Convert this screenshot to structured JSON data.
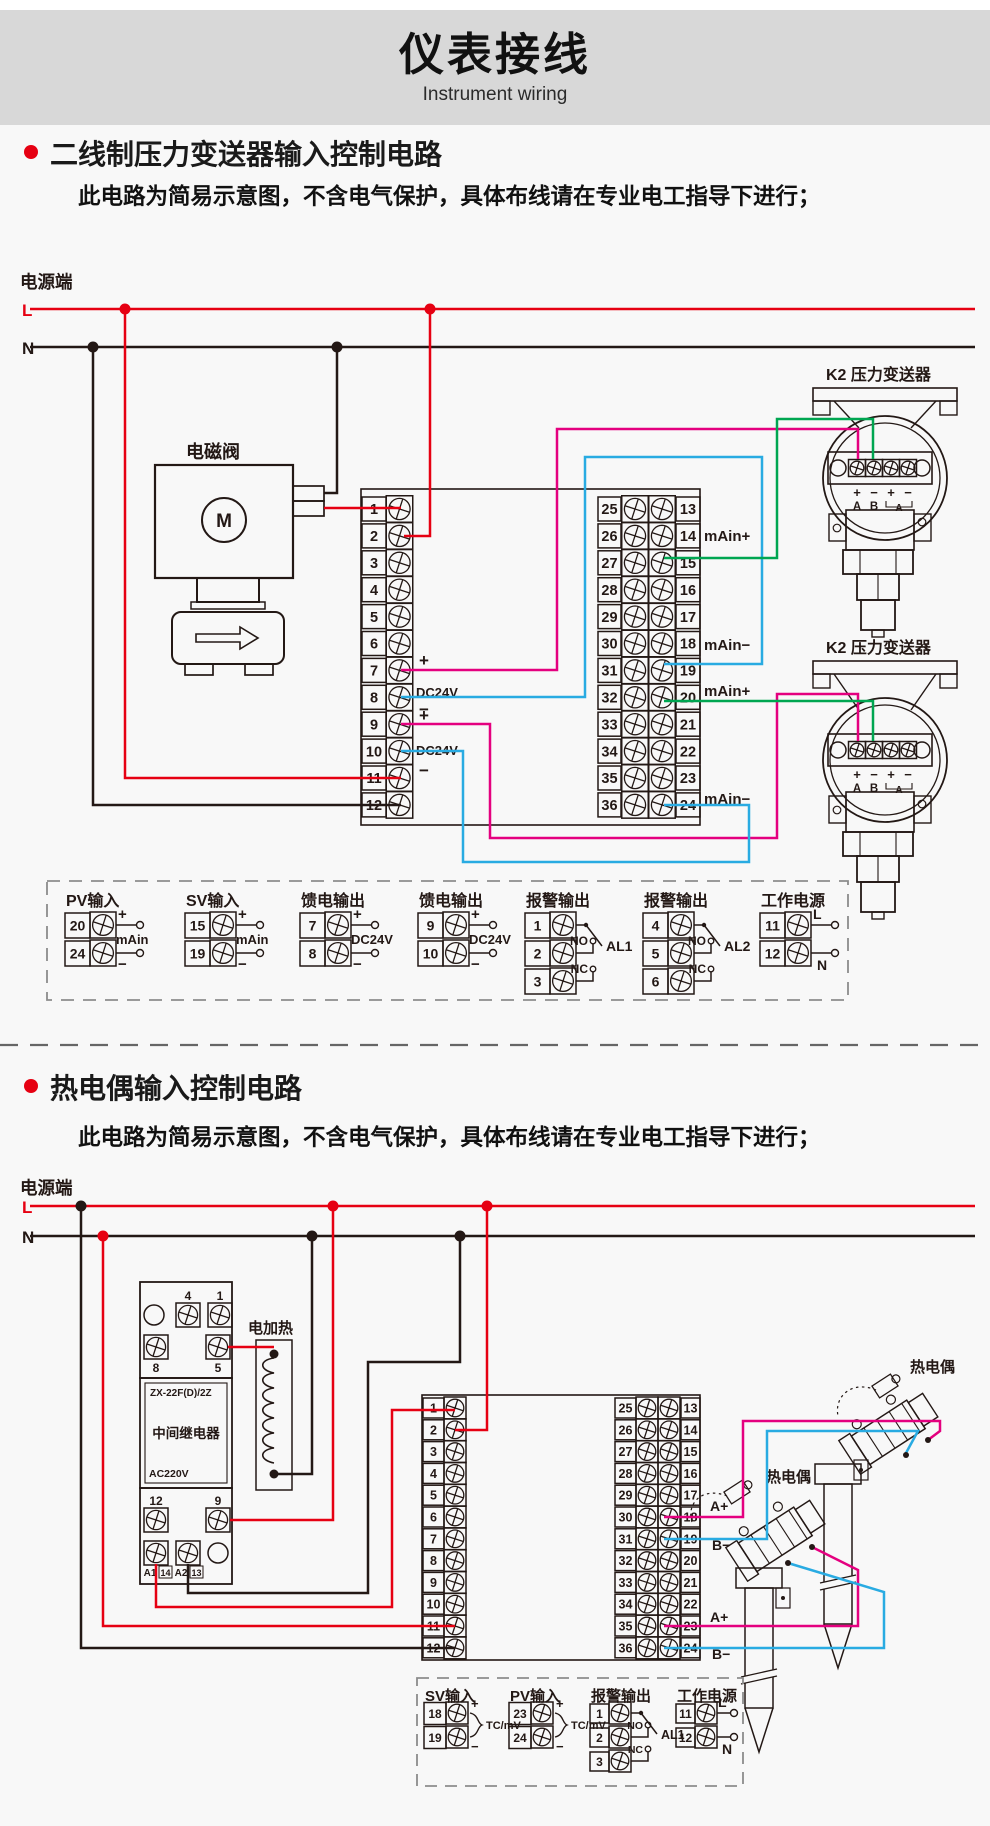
{
  "colors": {
    "red": "#e60012",
    "dark": "#231815",
    "magenta": "#e4007f",
    "blue": "#29abe2",
    "green": "#00a651",
    "gray_band": "#d8d8d8",
    "page_bg": "#f8f8f8",
    "dash": "#8c8c8c"
  },
  "header": {
    "title": "仪表接线",
    "subtitle": "Instrument wiring"
  },
  "section1": {
    "heading": "二线制压力变送器输入控制电路",
    "note": "此电路为简易示意图，不含电气保护，具体布线请在专业电工指导下进行；",
    "power_label": "电源端",
    "line_l": "L",
    "line_n": "N",
    "solenoid_label": "电磁阀",
    "solenoid_m": "M",
    "left_terminals": [
      "1",
      "2",
      "3",
      "4",
      "5",
      "6",
      "7",
      "8",
      "9",
      "10",
      "11",
      "12"
    ],
    "right_terminals_outer": [
      "25",
      "26",
      "27",
      "28",
      "29",
      "30",
      "31",
      "32",
      "33",
      "34",
      "35",
      "36"
    ],
    "right_terminals_inner": [
      "13",
      "14",
      "15",
      "16",
      "17",
      "18",
      "19",
      "20",
      "21",
      "22",
      "23",
      "24"
    ],
    "feed_labels": [
      {
        "plus": "+",
        "name": "DC24V",
        "minus": "−"
      },
      {
        "plus": "+",
        "name": "DC24V",
        "minus": "−"
      }
    ],
    "signal_labels": [
      "mAin+",
      "mAin−",
      "mAin+",
      "mAin−"
    ],
    "transmitter1_label": "K2 压力变送器",
    "transmitter2_label": "K2 压力变送器",
    "transmitter_terms": [
      "+",
      "−",
      "+",
      "−"
    ],
    "transmitter_ab": [
      "A",
      "B"
    ],
    "transmitter_loop": "A",
    "legend": {
      "groups": [
        {
          "type": "io",
          "title": "PV输入",
          "rows": [
            {
              "n": "20",
              "sign": "+"
            },
            {
              "n": "24",
              "sign": "−"
            }
          ],
          "mid": "mAin"
        },
        {
          "type": "io",
          "title": "SV输入",
          "rows": [
            {
              "n": "15",
              "sign": "+"
            },
            {
              "n": "19",
              "sign": "−"
            }
          ],
          "mid": "mAin"
        },
        {
          "type": "io",
          "title": "馈电输出",
          "rows": [
            {
              "n": "7",
              "sign": "+"
            },
            {
              "n": "8",
              "sign": "−"
            }
          ],
          "mid": "DC24V"
        },
        {
          "type": "io",
          "title": "馈电输出",
          "rows": [
            {
              "n": "9",
              "sign": "+"
            },
            {
              "n": "10",
              "sign": "−"
            }
          ],
          "mid": "DC24V"
        },
        {
          "type": "alarm",
          "title": "报警输出",
          "rows": [
            {
              "n": "1"
            },
            {
              "n": "2"
            },
            {
              "n": "3"
            }
          ],
          "no": "NO",
          "nc": "NC",
          "al": "AL1"
        },
        {
          "type": "alarm",
          "title": "报警输出",
          "rows": [
            {
              "n": "4"
            },
            {
              "n": "5"
            },
            {
              "n": "6"
            }
          ],
          "no": "NO",
          "nc": "NC",
          "al": "AL2"
        },
        {
          "type": "power",
          "title": "工作电源",
          "rows": [
            {
              "n": "11",
              "sign": "L"
            },
            {
              "n": "12",
              "sign": "N"
            }
          ]
        }
      ]
    }
  },
  "section2": {
    "heading": "热电偶输入控制电路",
    "note": "此电路为简易示意图，不含电气保护，具体布线请在专业电工指导下进行；",
    "power_label": "电源端",
    "line_l": "L",
    "line_n": "N",
    "relay": {
      "pins_top": [
        "4",
        "1"
      ],
      "pins_mid": [
        "8",
        "5"
      ],
      "model": "ZX-22F(D)/2Z",
      "name": "中间继电器",
      "voltage": "AC220V",
      "pins_row3": [
        "12",
        "9"
      ],
      "pins_bottom": [
        "A1",
        "14",
        "A2",
        "13"
      ]
    },
    "heater_label": "电加热",
    "left_terminals": [
      "1",
      "2",
      "3",
      "4",
      "5",
      "6",
      "7",
      "8",
      "9",
      "10",
      "11",
      "12"
    ],
    "right_terminals_outer": [
      "25",
      "26",
      "27",
      "28",
      "29",
      "30",
      "31",
      "32",
      "33",
      "34",
      "35",
      "36"
    ],
    "right_terminals_inner": [
      "13",
      "14",
      "15",
      "16",
      "17",
      "18",
      "19",
      "20",
      "21",
      "22",
      "23",
      "24"
    ],
    "tc_labels": [
      "热电偶",
      "热电偶"
    ],
    "signal_labels": [
      "A+",
      "B−",
      "A+",
      "B−"
    ],
    "legend": {
      "groups": [
        {
          "type": "tc",
          "title": "SV输入",
          "rows": [
            {
              "n": "18",
              "sign": "+"
            },
            {
              "n": "19",
              "sign": "−"
            }
          ],
          "mid": "TC/mV"
        },
        {
          "type": "tc",
          "title": "PV输入",
          "rows": [
            {
              "n": "23",
              "sign": "+"
            },
            {
              "n": "24",
              "sign": "−"
            }
          ],
          "mid": "TC/mV"
        },
        {
          "type": "alarm",
          "title": "报警输出",
          "rows": [
            {
              "n": "1"
            },
            {
              "n": "2"
            },
            {
              "n": "3"
            }
          ],
          "no": "NO",
          "nc": "NC",
          "al": "AL1"
        },
        {
          "type": "power",
          "title": "工作电源",
          "rows": [
            {
              "n": "11",
              "sign": "L"
            },
            {
              "n": "12",
              "sign": "N"
            }
          ]
        }
      ]
    }
  }
}
